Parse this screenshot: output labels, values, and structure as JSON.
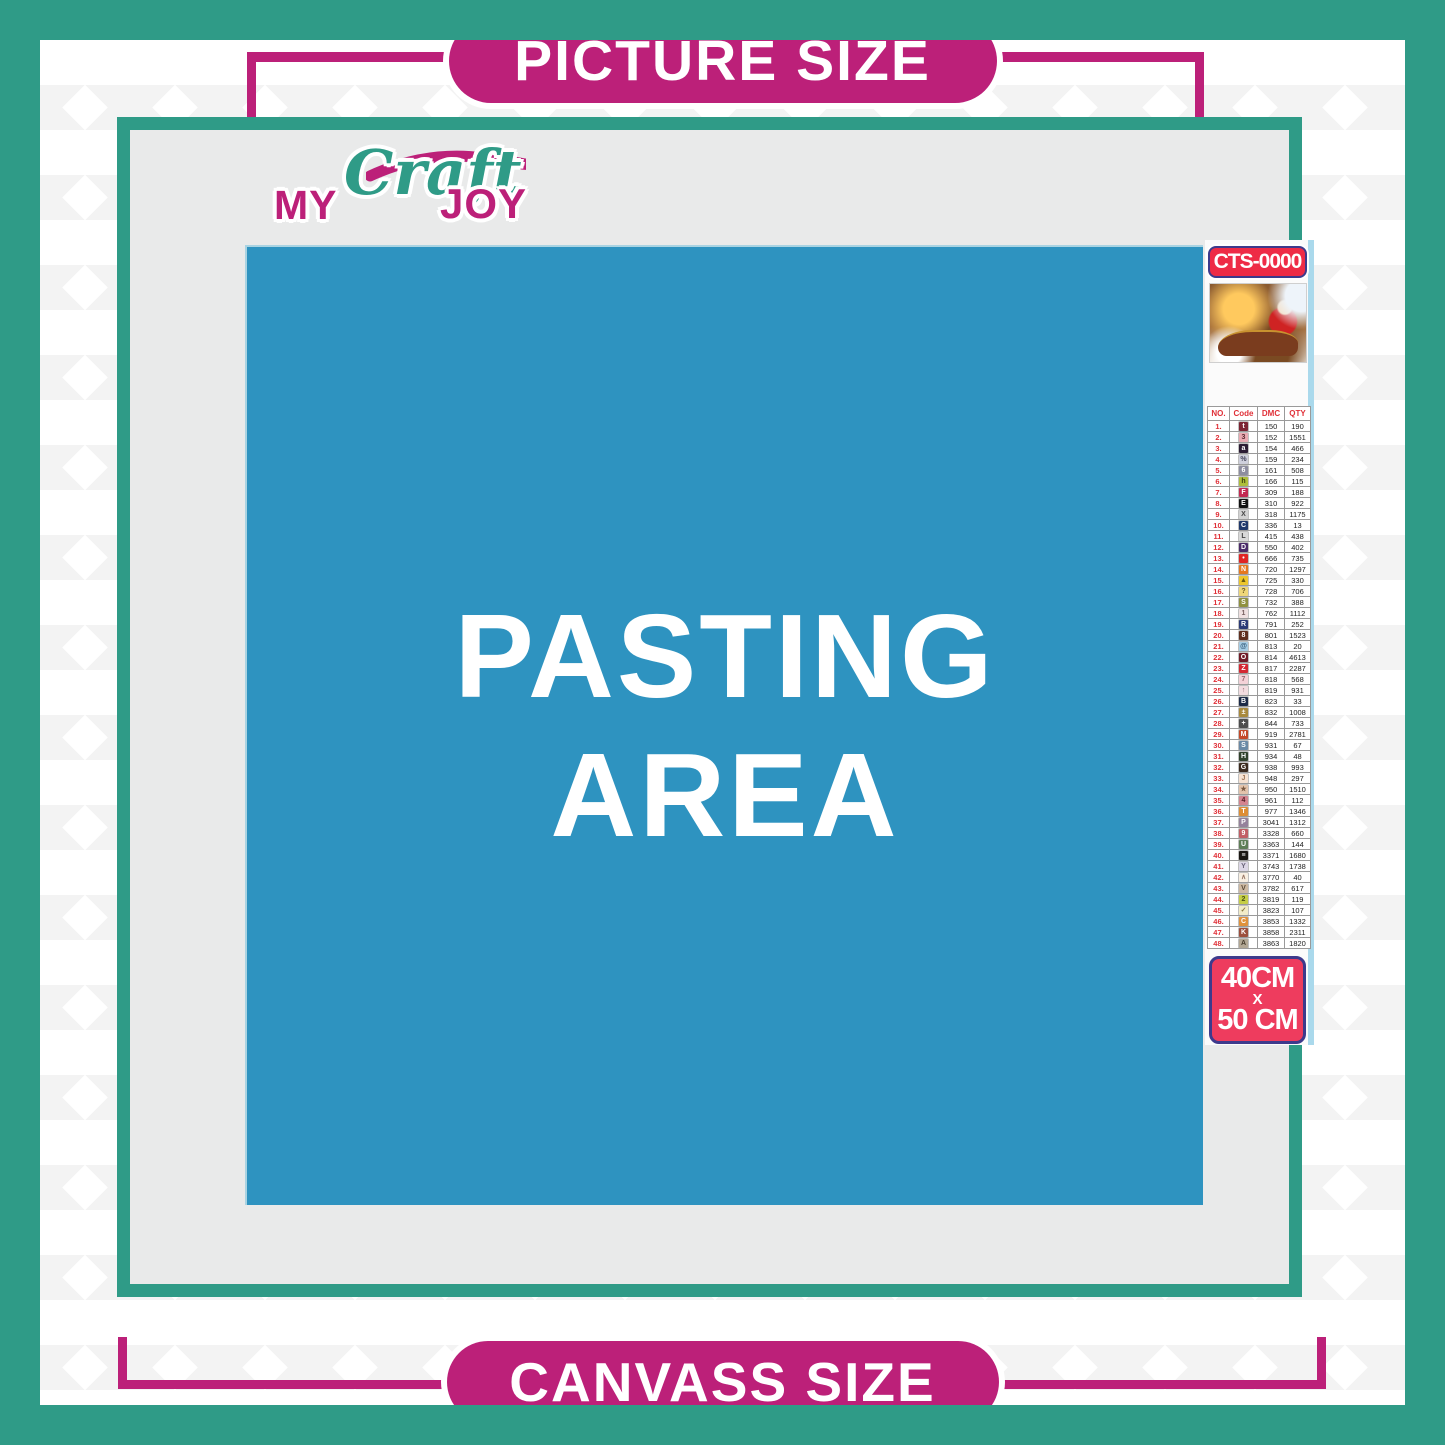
{
  "header_pill": {
    "label": "PICTURE SIZE"
  },
  "footer_pill": {
    "label": "CANVASS SIZE"
  },
  "logo": {
    "my": "MY",
    "craft": "Craft",
    "joy": "JOY"
  },
  "pasting_area": {
    "line1": "PASTING",
    "line2": "AREA"
  },
  "kit": {
    "sku": "CTS-0000",
    "thumbnail_icon": "christmas-santa-sleigh-scene",
    "size": {
      "width_label": "40CM",
      "separator": "X",
      "height_label": "50 CM"
    }
  },
  "legend": {
    "headers": [
      "NO.",
      "Code",
      "DMC",
      "QTY"
    ],
    "rows": [
      {
        "no": "1.",
        "sym": "t",
        "bg": "#7b2433",
        "fg": "#ffffff",
        "dmc": "150",
        "qty": "190"
      },
      {
        "no": "2.",
        "sym": "3",
        "bg": "#e9aab2",
        "fg": "#5a2a30",
        "dmc": "152",
        "qty": "1551"
      },
      {
        "no": "3.",
        "sym": "a",
        "bg": "#2b1c33",
        "fg": "#ffffff",
        "dmc": "154",
        "qty": "466"
      },
      {
        "no": "4.",
        "sym": "%",
        "bg": "#cfd0dc",
        "fg": "#44445a",
        "dmc": "159",
        "qty": "234"
      },
      {
        "no": "5.",
        "sym": "6",
        "bg": "#8d8d9f",
        "fg": "#ffffff",
        "dmc": "161",
        "qty": "508"
      },
      {
        "no": "6.",
        "sym": "h",
        "bg": "#aebe3a",
        "fg": "#3a4210",
        "dmc": "166",
        "qty": "115"
      },
      {
        "no": "7.",
        "sym": "F",
        "bg": "#c22a52",
        "fg": "#ffffff",
        "dmc": "309",
        "qty": "188"
      },
      {
        "no": "8.",
        "sym": "E",
        "bg": "#121212",
        "fg": "#ffffff",
        "dmc": "310",
        "qty": "922"
      },
      {
        "no": "9.",
        "sym": "X",
        "bg": "#d2d2d2",
        "fg": "#444444",
        "dmc": "318",
        "qty": "1175"
      },
      {
        "no": "10.",
        "sym": "C",
        "bg": "#20386b",
        "fg": "#ffffff",
        "dmc": "336",
        "qty": "13"
      },
      {
        "no": "11.",
        "sym": "L",
        "bg": "#d9d9d9",
        "fg": "#444444",
        "dmc": "415",
        "qty": "438"
      },
      {
        "no": "12.",
        "sym": "D",
        "bg": "#4b2b69",
        "fg": "#ffffff",
        "dmc": "550",
        "qty": "402"
      },
      {
        "no": "13.",
        "sym": "•",
        "bg": "#e02424",
        "fg": "#ffffff",
        "dmc": "666",
        "qty": "735"
      },
      {
        "no": "14.",
        "sym": "N",
        "bg": "#e5781f",
        "fg": "#ffffff",
        "dmc": "720",
        "qty": "1297"
      },
      {
        "no": "15.",
        "sym": "▲",
        "bg": "#edc62c",
        "fg": "#6a5a10",
        "dmc": "725",
        "qty": "330"
      },
      {
        "no": "16.",
        "sym": "?",
        "bg": "#efd77a",
        "fg": "#6a5a20",
        "dmc": "728",
        "qty": "706"
      },
      {
        "no": "17.",
        "sym": "S",
        "bg": "#8f9140",
        "fg": "#ffffff",
        "dmc": "732",
        "qty": "388"
      },
      {
        "no": "18.",
        "sym": "1",
        "bg": "#efe0e0",
        "fg": "#776060",
        "dmc": "762",
        "qty": "1112"
      },
      {
        "no": "19.",
        "sym": "R",
        "bg": "#2c3b76",
        "fg": "#ffffff",
        "dmc": "791",
        "qty": "252"
      },
      {
        "no": "20.",
        "sym": "8",
        "bg": "#5f3020",
        "fg": "#ffffff",
        "dmc": "801",
        "qty": "1523"
      },
      {
        "no": "21.",
        "sym": "@",
        "bg": "#a6cce4",
        "fg": "#355a77",
        "dmc": "813",
        "qty": "20"
      },
      {
        "no": "22.",
        "sym": "O",
        "bg": "#701c28",
        "fg": "#ffffff",
        "dmc": "814",
        "qty": "4613"
      },
      {
        "no": "23.",
        "sym": "Z",
        "bg": "#d42833",
        "fg": "#ffffff",
        "dmc": "817",
        "qty": "2287"
      },
      {
        "no": "24.",
        "sym": "7",
        "bg": "#f4d2d8",
        "fg": "#96666e",
        "dmc": "818",
        "qty": "568"
      },
      {
        "no": "25.",
        "sym": "↑",
        "bg": "#f2dce0",
        "fg": "#966670",
        "dmc": "819",
        "qty": "931"
      },
      {
        "no": "26.",
        "sym": "B",
        "bg": "#1c2a47",
        "fg": "#ffffff",
        "dmc": "823",
        "qty": "33"
      },
      {
        "no": "27.",
        "sym": "±",
        "bg": "#a8893d",
        "fg": "#ffffff",
        "dmc": "832",
        "qty": "1008"
      },
      {
        "no": "28.",
        "sym": "+",
        "bg": "#4e4e4e",
        "fg": "#ffffff",
        "dmc": "844",
        "qty": "733"
      },
      {
        "no": "29.",
        "sym": "M",
        "bg": "#c44a2a",
        "fg": "#ffffff",
        "dmc": "919",
        "qty": "2781"
      },
      {
        "no": "30.",
        "sym": "S",
        "bg": "#6a89a5",
        "fg": "#ffffff",
        "dmc": "931",
        "qty": "67"
      },
      {
        "no": "31.",
        "sym": "H",
        "bg": "#31422c",
        "fg": "#ffffff",
        "dmc": "934",
        "qty": "48"
      },
      {
        "no": "32.",
        "sym": "G",
        "bg": "#3b2a1e",
        "fg": "#ffffff",
        "dmc": "938",
        "qty": "993"
      },
      {
        "no": "33.",
        "sym": "J",
        "bg": "#f6e2d2",
        "fg": "#a07858",
        "dmc": "948",
        "qty": "297"
      },
      {
        "no": "34.",
        "sym": "★",
        "bg": "#e3c4ac",
        "fg": "#7a5a42",
        "dmc": "950",
        "qty": "1510"
      },
      {
        "no": "35.",
        "sym": "4",
        "bg": "#d4848f",
        "fg": "#5a2028",
        "dmc": "961",
        "qty": "112"
      },
      {
        "no": "36.",
        "sym": "T",
        "bg": "#dd8e35",
        "fg": "#ffffff",
        "dmc": "977",
        "qty": "1346"
      },
      {
        "no": "37.",
        "sym": "P",
        "bg": "#95829b",
        "fg": "#ffffff",
        "dmc": "3041",
        "qty": "1312"
      },
      {
        "no": "38.",
        "sym": "9",
        "bg": "#c15f66",
        "fg": "#ffffff",
        "dmc": "3328",
        "qty": "660"
      },
      {
        "no": "39.",
        "sym": "U",
        "bg": "#5e7e57",
        "fg": "#ffffff",
        "dmc": "3363",
        "qty": "144"
      },
      {
        "no": "40.",
        "sym": "≡",
        "bg": "#1a1713",
        "fg": "#ffffff",
        "dmc": "3371",
        "qty": "1680"
      },
      {
        "no": "41.",
        "sym": "Y",
        "bg": "#dcd7e6",
        "fg": "#6a6478",
        "dmc": "3743",
        "qty": "1738"
      },
      {
        "no": "42.",
        "sym": "∧",
        "bg": "#f8efe2",
        "fg": "#997766",
        "dmc": "3770",
        "qty": "40"
      },
      {
        "no": "43.",
        "sym": "V",
        "bg": "#cdb9a2",
        "fg": "#5a4a38",
        "dmc": "3782",
        "qty": "617"
      },
      {
        "no": "44.",
        "sym": "2",
        "bg": "#c5ce46",
        "fg": "#4a5216",
        "dmc": "3819",
        "qty": "119"
      },
      {
        "no": "45.",
        "sym": "✓",
        "bg": "#f2ecc8",
        "fg": "#8a7a40",
        "dmc": "3823",
        "qty": "107"
      },
      {
        "no": "46.",
        "sym": "C",
        "bg": "#e0923c",
        "fg": "#ffffff",
        "dmc": "3853",
        "qty": "1332"
      },
      {
        "no": "47.",
        "sym": "K",
        "bg": "#9c4f3d",
        "fg": "#ffffff",
        "dmc": "3858",
        "qty": "2311"
      },
      {
        "no": "48.",
        "sym": "A",
        "bg": "#b2a794",
        "fg": "#463d2e",
        "dmc": "3863",
        "qty": "1820"
      }
    ]
  },
  "colors": {
    "teal": "#2f9b87",
    "magenta": "#bc2079",
    "blue": "#2e93c0",
    "panel-gray": "#e9eaea",
    "pattern": "#f3f3f3",
    "badge-red": "#ee2b46",
    "size-red": "#ee3c5e",
    "badge-border": "#3d3a8c",
    "strip-blue": "#aad9ec",
    "table-red": "#e03038",
    "ink": "#222222"
  }
}
